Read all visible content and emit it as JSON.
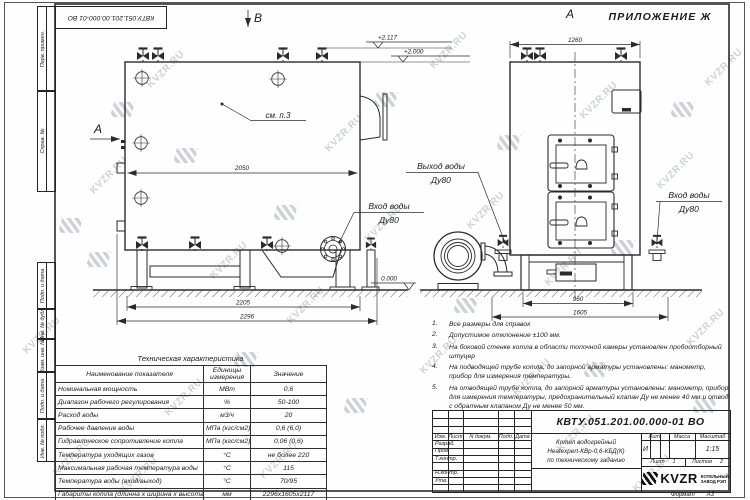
{
  "watermark": {
    "text": "KVZR.RU"
  },
  "frame": {
    "top_stamp": "КВТУ.051.201.00.000-01 ВО",
    "margin_labels_top": [
      "Перв. примен.",
      "Справ. №"
    ],
    "margin_labels_bottom": [
      "Подп. и дата",
      "Инв. № дубл.",
      "Взам. инв. №",
      "Подп. и дата",
      "Инв. № подл."
    ]
  },
  "drawing": {
    "appendix": "ПРИЛОЖЕНИЕ Ж",
    "view_a": "А",
    "view_b": "В",
    "view_a_front": "А",
    "see_note": "см. п.3",
    "labels": {
      "outlet_line1": "Выход воды",
      "outlet_line2": "Ду80",
      "inlet_left_line1": "Вход воды",
      "inlet_left_line2": "Ду80",
      "inlet_right_line1": "Вход воды",
      "inlet_right_line2": "Ду80"
    },
    "elevations": {
      "e1": "+2.117",
      "e2": "+2.000",
      "ground": "0.000"
    },
    "dims": {
      "d2050": "2050",
      "d2205": "2205",
      "d2296": "2296",
      "d1260": "1260",
      "d960": "960",
      "d1605": "1605"
    }
  },
  "notes": {
    "items": [
      {
        "num": "1.",
        "text": "Все размеры для справок"
      },
      {
        "num": "2.",
        "text": "Допустимое отклонение ±100 мм."
      },
      {
        "num": "3.",
        "text": "На боковой стенке котла в области топочной камеры установлен пробоотборный штуцер"
      },
      {
        "num": "4.",
        "text": "На подводящей трубе котла, до запорной арматуры установлены: манометр, прибор для измерения температуры."
      },
      {
        "num": "5.",
        "text": "На отводящей трубе котла, до запорной арматуры установлены: манометр, прибор для измерения температуры, предохранительный клапан Ду не менее 40 мм и отвод с обратным клапаном Ду не менее 50 мм."
      }
    ]
  },
  "tech_table": {
    "title": "Техническая характеристика",
    "headers": {
      "name": "Наименование показателя",
      "unit_line1": "Единицы",
      "unit_line2": "измерения",
      "value": "Значение"
    },
    "rows": [
      {
        "name": "Номинальная мощность",
        "unit": "МВт",
        "value": "0,6"
      },
      {
        "name": "Диапазон рабочего регулирования",
        "unit": "%",
        "value": "50-100"
      },
      {
        "name": "Расход воды",
        "unit": "м3/ч",
        "value": "20"
      },
      {
        "name": "Рабочее давление воды",
        "unit": "МПа (кгс/см2)",
        "value": "0,6 (6,0)"
      },
      {
        "name": "Гидравлическое сопротивление котла",
        "unit": "МПа (кгс/см2)",
        "value": "0,06 (0,6)"
      },
      {
        "name": "Температура уходящих газов",
        "unit": "°С",
        "value": "не более 220"
      },
      {
        "name": "Максимальная рабочая температура воды",
        "unit": "°С",
        "value": "115"
      },
      {
        "name": "Температура воды (вход/выход)",
        "unit": "°С",
        "value": "70/95"
      },
      {
        "name": "Габариты котла (длинна х ширина х высота)",
        "unit": "мм",
        "value": "2296х1605х2117"
      }
    ]
  },
  "title_block": {
    "doc_number": "КВТУ.051.201.00.000-01 ВО",
    "product_line1": "Котел водогрейный",
    "product_line2": "Heatexpert-КВр-0,6-КБД(К)",
    "product_line3": "по техническому заданию",
    "cols": {
      "izm": "Изм.",
      "list": "Лист",
      "doc": "N докум.",
      "sign": "Подп.",
      "date": "Дата"
    },
    "row_labels": [
      "Разраб.",
      "Пров.",
      "Т.контр.",
      "",
      "Н.контр.",
      "Утв."
    ],
    "lit_label": "Лит.",
    "lit_value": "И",
    "mass_label": "Масса",
    "scale_label": "Масштаб",
    "scale_value": "1:15",
    "sheet_label": "Лист",
    "sheet_value": "1",
    "sheets_label": "Листов",
    "sheets_value": "2",
    "logo_text": "KVZR",
    "company_line1": "КОТЕЛЬНЫЙ",
    "company_line2": "ЗАВОД РЭП",
    "format_label": "Формат",
    "format_value": "А3"
  }
}
